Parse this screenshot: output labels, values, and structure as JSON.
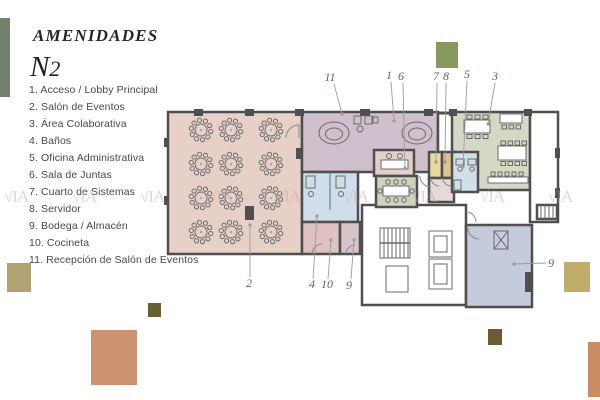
{
  "header": {
    "title": "AMENIDADES",
    "level_main": "N",
    "level_sub": "2"
  },
  "legend": {
    "items": [
      "1. Acceso / Lobby Principal",
      "2. Salón de Eventos",
      "3. Área Colaborativa",
      "4. Baños",
      "5. Oficina Administrativa",
      "6. Sala de Juntas",
      "7. Cuarto de Sistemas",
      "8. Servidor",
      "9. Bodega / Almacén",
      "10. Cocineta",
      "11. Recepción de Salón de Eventos"
    ]
  },
  "watermark": {
    "text": "VIA",
    "mark": "√IA"
  },
  "colors": {
    "wall": "#4f4f4f",
    "furniture": "#6a6a6a",
    "white": "#ffffff",
    "salon": "#e7d0c7",
    "reception": "#d0c0ce",
    "lobby_desk": "#e4cfca",
    "banos": "#cfdeea",
    "cocineta": "#dfc2c1",
    "bodega_small": "#d8c3c9",
    "juntas": "#ccd4bc",
    "sistemas": "#e9d9a1",
    "servidor": "#dfc193",
    "oficina": "#cfe0e8",
    "colaborativa": "#d3d9c4",
    "bodega_big": "#c5cadd",
    "small_wc": "#e6d9dc",
    "label": "#7d5851",
    "leader": "#9a9a9a",
    "watermark": "#cf9f9f"
  },
  "plan": {
    "rooms": [
      {
        "name": "salon-de-eventos",
        "fill": "salon",
        "x": 168,
        "y": 112,
        "w": 134,
        "h": 142
      },
      {
        "name": "recepcion-salon-eventos",
        "fill": "reception",
        "x": 302,
        "y": 112,
        "w": 136,
        "h": 60
      },
      {
        "name": "area-colaborativa",
        "fill": "colaborativa",
        "x": 452,
        "y": 112,
        "w": 78,
        "h": 78
      },
      {
        "name": "pasillo-derecho",
        "fill": "white",
        "x": 530,
        "y": 112,
        "w": 28,
        "h": 110
      },
      {
        "name": "nucleo-servicios",
        "fill": "white",
        "x": 362,
        "y": 205,
        "w": 104,
        "h": 100
      },
      {
        "name": "banos",
        "fill": "banos",
        "x": 302,
        "y": 172,
        "w": 56,
        "h": 50
      },
      {
        "name": "cocineta",
        "fill": "cocineta",
        "x": 302,
        "y": 222,
        "w": 38,
        "h": 32
      },
      {
        "name": "bodega-chica",
        "fill": "bodega_small",
        "x": 340,
        "y": 222,
        "w": 20,
        "h": 32
      },
      {
        "name": "lobby",
        "fill": "lobby_desk",
        "x": 374,
        "y": 150,
        "w": 40,
        "h": 26
      },
      {
        "name": "sala-de-juntas",
        "fill": "juntas",
        "x": 376,
        "y": 176,
        "w": 41,
        "h": 31
      },
      {
        "name": "cuarto-sistemas",
        "fill": "sistemas",
        "x": 429,
        "y": 152,
        "w": 13,
        "h": 26
      },
      {
        "name": "servidor",
        "fill": "servidor",
        "x": 442,
        "y": 152,
        "w": 12,
        "h": 26
      },
      {
        "name": "wc-chico",
        "fill": "small_wc",
        "x": 429,
        "y": 178,
        "w": 25,
        "h": 24
      },
      {
        "name": "oficina-administrativa",
        "fill": "oficina",
        "x": 452,
        "y": 152,
        "w": 26,
        "h": 40
      },
      {
        "name": "bodega-almacen",
        "fill": "bodega_big",
        "x": 466,
        "y": 225,
        "w": 66,
        "h": 82
      },
      {
        "name": "escalera-derecha",
        "fill": "white",
        "x": 537,
        "y": 205,
        "w": 20,
        "h": 14
      }
    ],
    "banquet_tables": {
      "cols": [
        201,
        231,
        271
      ],
      "rows": [
        130,
        164,
        198,
        232
      ]
    },
    "labels": [
      {
        "text": "11",
        "x": 330,
        "y": 81
      },
      {
        "text": "1",
        "x": 389,
        "y": 79
      },
      {
        "text": "6",
        "x": 401,
        "y": 80
      },
      {
        "text": "7",
        "x": 436,
        "y": 80
      },
      {
        "text": "8",
        "x": 446,
        "y": 80
      },
      {
        "text": "5",
        "x": 467,
        "y": 78
      },
      {
        "text": "3",
        "x": 495,
        "y": 80
      },
      {
        "text": "2",
        "x": 249,
        "y": 287
      },
      {
        "text": "4",
        "x": 312,
        "y": 288
      },
      {
        "text": "10",
        "x": 327,
        "y": 288
      },
      {
        "text": "9",
        "x": 349,
        "y": 289
      },
      {
        "text": "9",
        "x": 551,
        "y": 267
      }
    ],
    "leaders": [
      [
        334,
        84,
        342,
        114
      ],
      [
        391,
        82,
        394,
        121
      ],
      [
        403,
        83,
        405,
        168
      ],
      [
        437,
        83,
        436,
        162
      ],
      [
        446,
        83,
        445,
        162
      ],
      [
        467,
        81,
        463,
        167
      ],
      [
        495,
        83,
        488,
        124
      ],
      [
        250,
        277,
        250,
        225
      ],
      [
        313,
        279,
        317,
        216
      ],
      [
        328,
        279,
        331,
        240
      ],
      [
        351,
        279,
        354,
        240
      ],
      [
        546,
        263,
        514,
        264
      ]
    ]
  },
  "decor": {
    "squares": [
      {
        "x": 0,
        "y": 18,
        "w": 10,
        "h": 79,
        "color": "#73806d"
      },
      {
        "x": 436,
        "y": 42,
        "w": 22,
        "h": 26,
        "color": "#87995f"
      },
      {
        "x": 7,
        "y": 263,
        "w": 24,
        "h": 29,
        "color": "#b2a172"
      },
      {
        "x": 148,
        "y": 303,
        "w": 13,
        "h": 14,
        "color": "#6a5d33"
      },
      {
        "x": 91,
        "y": 330,
        "w": 46,
        "h": 55,
        "color": "#cd9370"
      },
      {
        "x": 564,
        "y": 262,
        "w": 26,
        "h": 30,
        "color": "#c0ad6c"
      },
      {
        "x": 488,
        "y": 329,
        "w": 14,
        "h": 16,
        "color": "#6e5a30"
      },
      {
        "x": 588,
        "y": 342,
        "w": 12,
        "h": 55,
        "color": "#c98c63"
      }
    ]
  }
}
